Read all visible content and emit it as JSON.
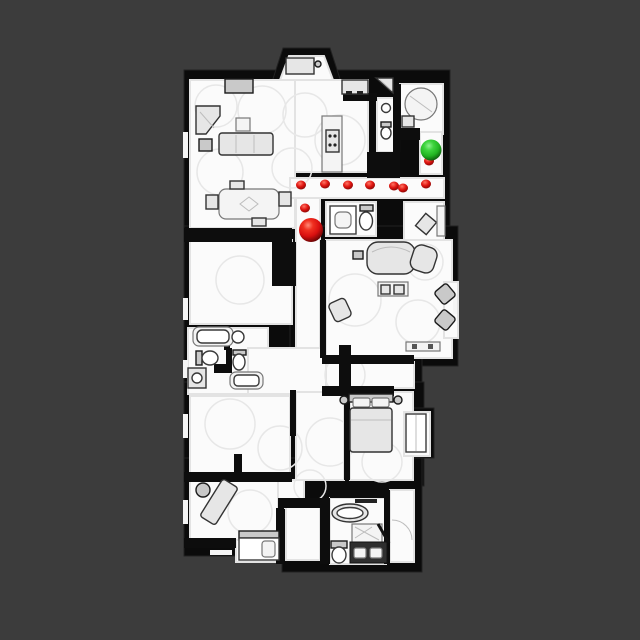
{
  "scene": {
    "title": "top-down-floor-map",
    "background_color": "#3c3c3c",
    "wall_color": "#0d0d0d",
    "floor_color": "#fbfbfb"
  },
  "map_data": {
    "type": "scatter",
    "view": {
      "width": 640,
      "height": 640
    },
    "goal_marker": {
      "label": "goal",
      "x": 431,
      "y": 150,
      "radius": 10.5,
      "color": "#2ec82e"
    },
    "agent_marker": {
      "label": "agent",
      "x": 311,
      "y": 230,
      "radius": 12,
      "color": "#e01212"
    },
    "path_dots": {
      "label": "path-waypoints",
      "color": "#e01510",
      "radius": 4.5,
      "points": [
        [
          305,
          208
        ],
        [
          301,
          185
        ],
        [
          325,
          184
        ],
        [
          348,
          185
        ],
        [
          370,
          185
        ],
        [
          394,
          186
        ],
        [
          403,
          188
        ],
        [
          426,
          184
        ],
        [
          429,
          161
        ]
      ]
    }
  }
}
